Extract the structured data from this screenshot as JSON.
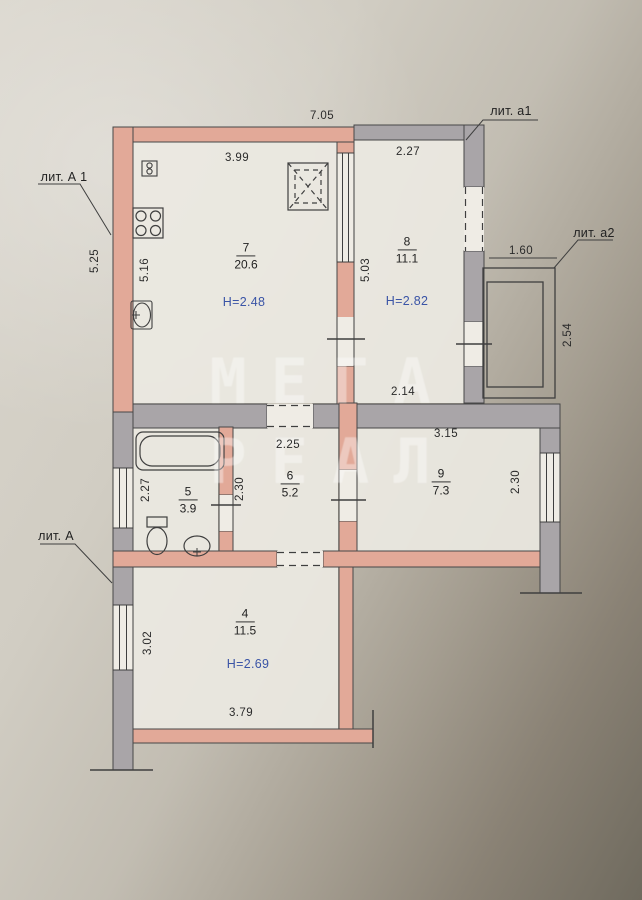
{
  "document_title": "floor-plan",
  "watermark": {
    "line1": "МЕГА",
    "line2": "РЕАЛ"
  },
  "litera_labels": {
    "lit_A1": "лит. А 1",
    "lit_a1": "лит. а1",
    "lit_a2": "лит. а2",
    "lit_A": "лит. А"
  },
  "rooms": {
    "room7": {
      "number": "7",
      "area": "20.6",
      "ceiling_height": "Н=2.48"
    },
    "room8": {
      "number": "8",
      "area": "11.1",
      "ceiling_height": "Н=2.82"
    },
    "room5": {
      "number": "5",
      "area": "3.9"
    },
    "room6": {
      "number": "6",
      "area": "5.2"
    },
    "room9": {
      "number": "9",
      "area": "7.3"
    },
    "room4": {
      "number": "4",
      "area": "11.5",
      "ceiling_height": "Н=2.69"
    }
  },
  "dimensions": {
    "overall_top": "7.05",
    "room7_width": "3.99",
    "room8_width": "2.27",
    "left_outer_height": "5.25",
    "room7_left_height": "5.16",
    "room7_right_height": "5.03",
    "balcony_width": "1.60",
    "balcony_depth": "2.54",
    "hall_upper": "2.14",
    "hall_width": "2.25",
    "room9_width": "3.15",
    "room5_height": "2.27",
    "room5_right": "2.30",
    "room9_depth": "2.30",
    "room4_left": "3.02",
    "room4_width": "3.79"
  },
  "colors": {
    "wall_pink": "#e2a998",
    "wall_gray": "#a9a5a8",
    "line": "#3f3f3f",
    "height_text_blue": "#3a54a6"
  }
}
